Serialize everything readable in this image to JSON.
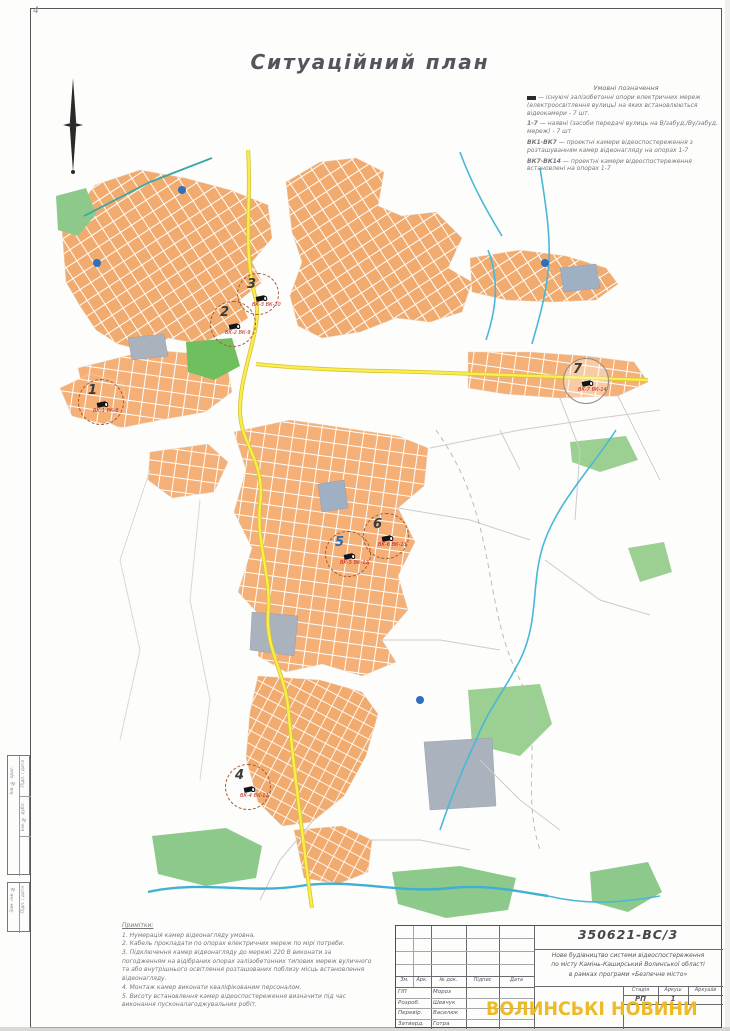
{
  "sheet": {
    "title": "Ситуаційний план",
    "corner_mark": "4"
  },
  "colors": {
    "block_orange": "#f2ab6e",
    "road_yellow": "#f8ef4a",
    "water_blue": "#49b8d8",
    "pond_blue": "#2f6fbe",
    "park_green": "#7cc36c",
    "industrial_gray": "#a9b2bd",
    "marker_dash_brown": "#a65a2e",
    "camera_label_red": "#c02020",
    "watermark_yellow": "#eeb71d"
  },
  "legend": {
    "heading": "Умовні позначення",
    "items": [
      {
        "prefix": "",
        "text": "— існуючі залізобетонні опори електричних мереж (електроосвітлення вулиць) на яких встановлюються відеокамери - 7 шт."
      },
      {
        "prefix": "1-7",
        "text": "— наявні (засоби передачі вулиць на В/забуд./Ву/забуд. мереж) - 7 шт"
      },
      {
        "prefix": "ВК1-ВК7",
        "text": "— проектні камери відеоспостереження з розташуванням камер відеонагляду на опорах 1-7"
      },
      {
        "prefix": "ВК7-ВК14",
        "text": "— проектні камери відеоспостереження встановлені на опорах 1-7"
      }
    ]
  },
  "map": {
    "markers": [
      {
        "num": "1",
        "vk1": "ВК-1",
        "vk2": "ВК-8"
      },
      {
        "num": "2",
        "vk1": "ВК-2",
        "vk2": "ВК-9"
      },
      {
        "num": "3",
        "vk1": "ВК-3",
        "vk2": "ВК-10"
      },
      {
        "num": "4",
        "vk1": "ВК-4",
        "vk2": "ВК-11"
      },
      {
        "num": "5",
        "vk1": "ВК-5",
        "vk2": "ВК-12"
      },
      {
        "num": "6",
        "vk1": "ВК-6",
        "vk2": "ВК-13"
      },
      {
        "num": "7",
        "vk1": "ВК-7",
        "vk2": "ВК-14"
      }
    ]
  },
  "notes": {
    "heading": "Примітки:",
    "lines": [
      "1. Нумерація камер відеонагляду умовна.",
      "2. Кабель прокладати по опорах електричних мереж по мірі потреби.",
      "3. Підключення камер відеонагляду до мережі 220 В виконати за погодженням на відібраних опорах залізобетонних типових мереж вуличного та або внутрішнього освітлення розташованих поблизу місць встановлення відеонагляду.",
      "4. Монтаж камер виконати кваліфікованим персоналом.",
      "5. Висоту встановлення камер відеоспостереження визначити під час виконання пусконалагоджувальних робіт."
    ]
  },
  "title_block": {
    "doc_number": "350621-ВС/3",
    "description_lines": [
      "Нове будівництво системи відеоспостереження",
      "по місту Камінь-Каширський Волинської області",
      "в рамках програми «Безпечне місто»"
    ],
    "header_cells": [
      "Зм.",
      "Арк.",
      "№ док.",
      "Підпис",
      "Дата"
    ],
    "stage": {
      "labels": [
        "Стадія",
        "Аркуш",
        "Аркушів"
      ],
      "values": [
        "РП",
        "1",
        ""
      ]
    },
    "roles": [
      {
        "role": "ГІП",
        "name": "Мороз"
      },
      {
        "role": "Розроб.",
        "name": "Шевчук"
      },
      {
        "role": "Перевір.",
        "name": "Василюк"
      },
      {
        "role": "Затверд.",
        "name": "Готра"
      }
    ]
  },
  "watermark": "ВОЛИНСЬКІ НОВИНИ",
  "side_stamp": {
    "box1": [
      "Інв. № ориг.",
      "Підп. і дата",
      "Інв. № дубл."
    ],
    "box2": [
      "Зам. інв. №",
      "Підп. і дата"
    ]
  }
}
